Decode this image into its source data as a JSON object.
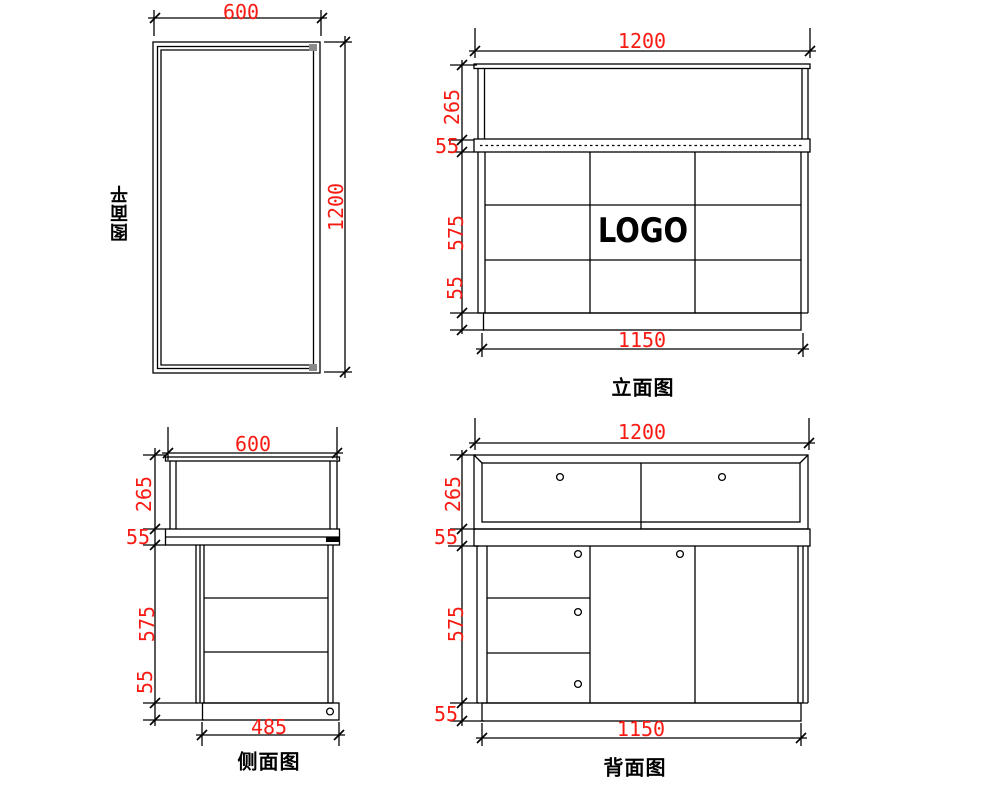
{
  "colors": {
    "dim_text": "#f71b14",
    "line": "#000000"
  },
  "plan": {
    "title": "平面图",
    "dim_width": "600",
    "dim_height": "1200"
  },
  "front": {
    "title": "立面图",
    "logo": "LOGO",
    "dim_top": "1200",
    "dim_bottom": "1150",
    "seg_glass": "265",
    "seg_counter": "55",
    "seg_body": "575",
    "seg_plinth": "55"
  },
  "side": {
    "title": "侧面图",
    "dim_top": "600",
    "dim_bottom": "485",
    "seg_glass": "265",
    "seg_counter": "55",
    "seg_body": "575",
    "seg_plinth": "55"
  },
  "back": {
    "title": "背面图",
    "dim_top": "1200",
    "dim_bottom": "1150",
    "seg_glass": "265",
    "seg_counter": "55",
    "seg_body": "575",
    "seg_plinth": "55"
  }
}
